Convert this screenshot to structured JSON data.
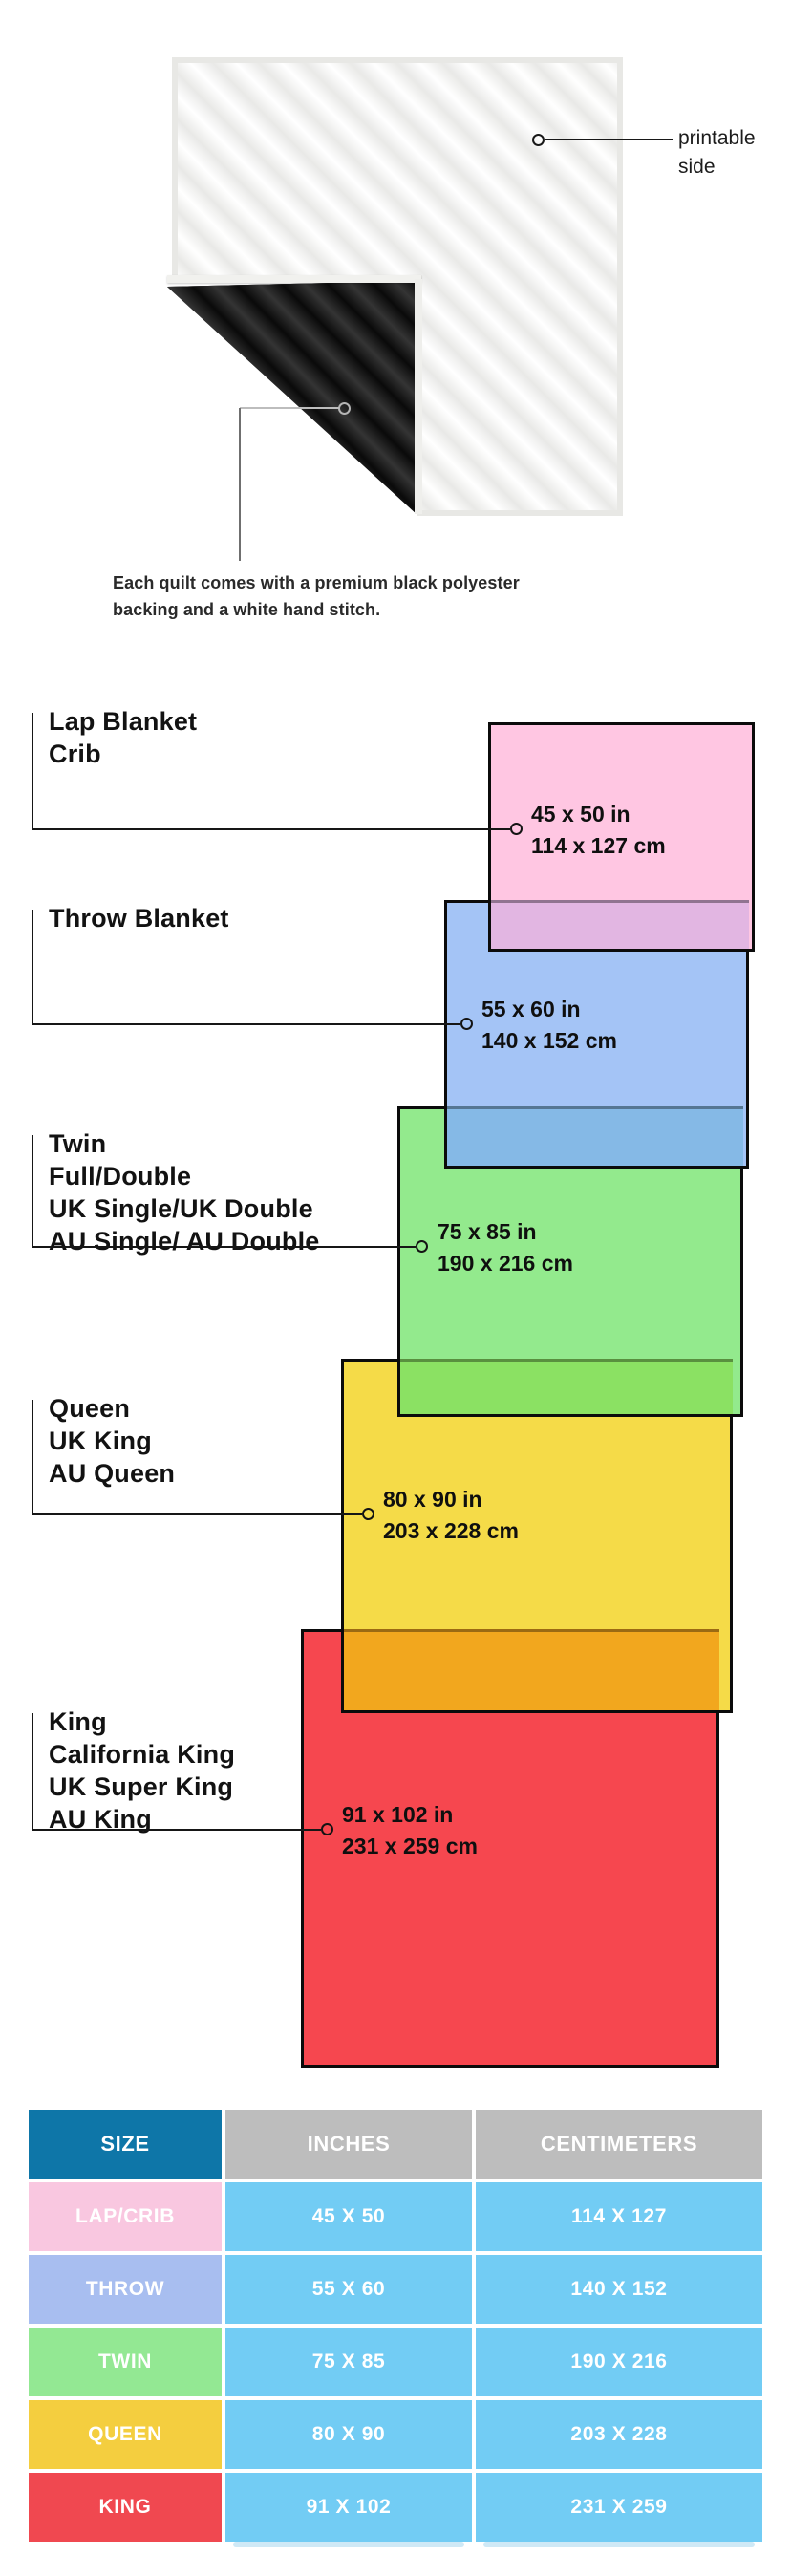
{
  "hero": {
    "printable_side_label": "printable side",
    "caption": "Each quilt comes with a premium black polyester backing and a white hand stitch."
  },
  "colors": {
    "diagram_pink": "#FFC6E2",
    "overlap_pink_blue": "#E2B6E2",
    "diagram_blue": "#A4C4F6",
    "overlap_blue_green": "#85B9E6",
    "diagram_green": "#93EA8D",
    "overlap_green_yellow": "#8BE163",
    "diagram_yellow": "#F5DB48",
    "overlap_yellow_red": "#F2A71E",
    "diagram_red": "#F6474F",
    "border_black": "#0B0B0B",
    "table_header_size_bg": "#0E76A8",
    "table_header_gray_bg": "#BDBDBD",
    "table_cell_blue": "#72CCF4",
    "row_lap_bg": "#F9C7E0",
    "row_throw_bg": "#A8BEF0",
    "row_twin_bg": "#93E893",
    "row_queen_bg": "#F4CE3F",
    "row_king_bg": "#F04850"
  },
  "diagram": {
    "sizes": [
      {
        "id": "lap-crib",
        "labels": [
          "Lap Blanket",
          "Crib"
        ],
        "inches": "45 x 50 in",
        "centimeters": "114 x 127 cm",
        "fill": "#FFC6E2"
      },
      {
        "id": "throw",
        "labels": [
          "Throw Blanket"
        ],
        "inches": "55 x 60 in",
        "centimeters": "140 x 152 cm",
        "fill": "#A4C4F6"
      },
      {
        "id": "twin",
        "labels": [
          "Twin",
          "Full/Double",
          "UK Single/UK Double",
          "AU Single/ AU Double"
        ],
        "inches": "75 x 85 in",
        "centimeters": "190 x 216 cm",
        "fill": "#93EA8D"
      },
      {
        "id": "queen",
        "labels": [
          "Queen",
          "UK King",
          "AU Queen"
        ],
        "inches": "80 x 90 in",
        "centimeters": "203 x 228 cm",
        "fill": "#F5DB48"
      },
      {
        "id": "king",
        "labels": [
          "King",
          "California King",
          "UK Super King",
          "AU King"
        ],
        "inches": "91 x 102 in",
        "centimeters": "231 x 259 cm",
        "fill": "#F6474F"
      }
    ]
  },
  "table": {
    "headers": [
      "SIZE",
      "INCHES",
      "CENTIMETERS"
    ],
    "rows": [
      {
        "size": "LAP/CRIB",
        "inches": "45 X 50",
        "centimeters": "114 X 127"
      },
      {
        "size": "THROW",
        "inches": "55 X 60",
        "centimeters": "140 X 152"
      },
      {
        "size": "TWIN",
        "inches": "75 X 85",
        "centimeters": "190 X 216"
      },
      {
        "size": "QUEEN",
        "inches": "80 X 90",
        "centimeters": "203 X 228"
      },
      {
        "size": "KING",
        "inches": "91 X 102",
        "centimeters": "231 X 259"
      }
    ]
  }
}
